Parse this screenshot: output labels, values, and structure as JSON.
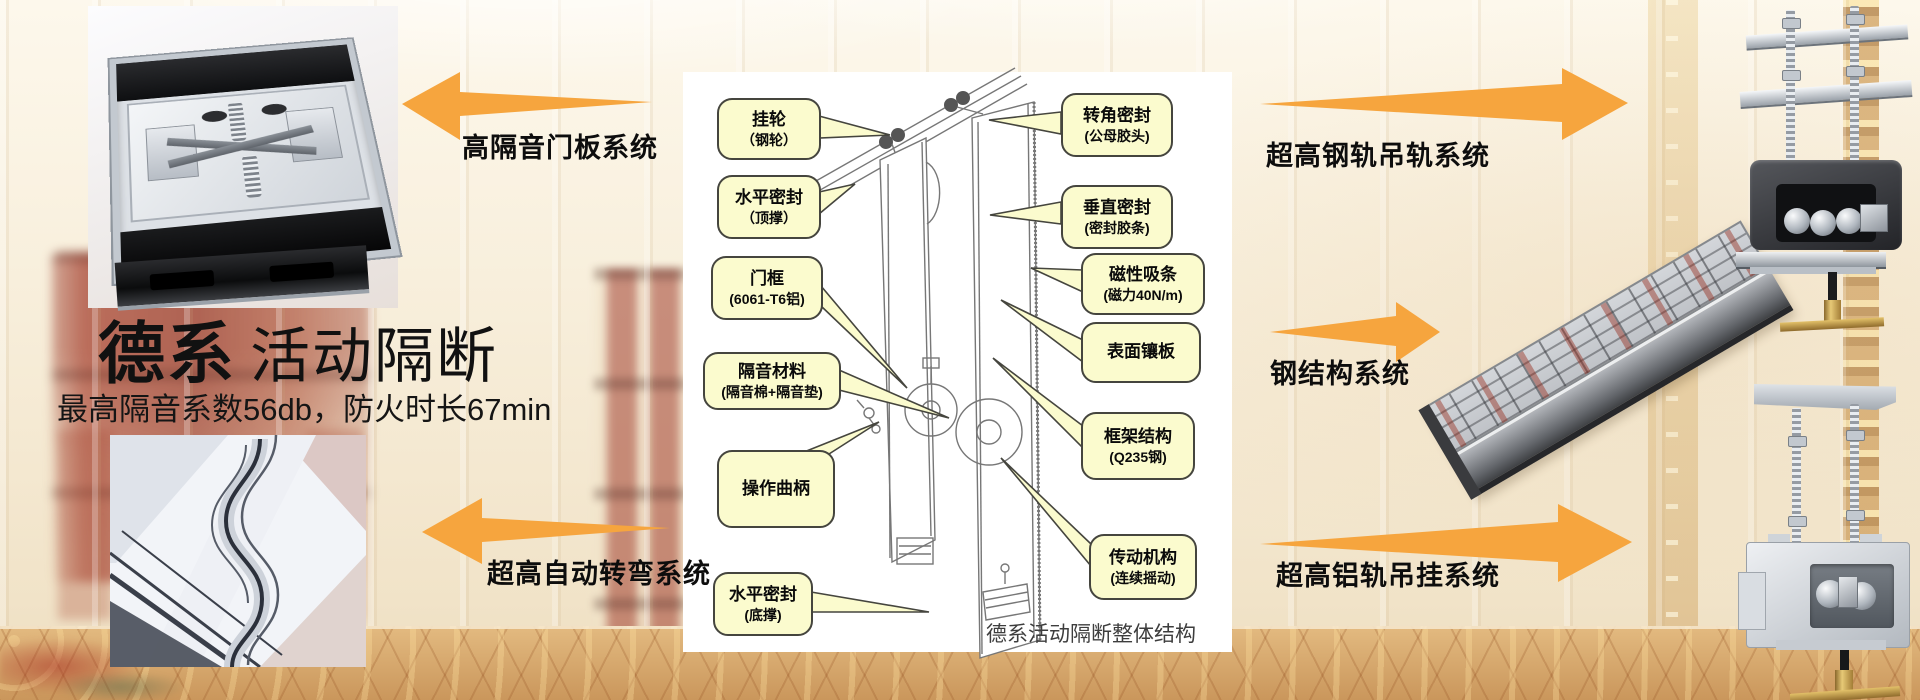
{
  "header": {
    "title_strong": "德系",
    "title_rest": "活动隔断",
    "subtitle": "最高隔音系数56db，防火时长67min"
  },
  "diagram": {
    "caption": "德系活动隔断整体结构",
    "labels_left": [
      {
        "line1": "挂轮",
        "line2": "（钢轮）"
      },
      {
        "line1": "水平密封",
        "line2": "（顶撑）"
      },
      {
        "line1": "门框",
        "line2": "(6061-T6铝)"
      },
      {
        "line1": "隔音材料",
        "line2": "(隔音棉+隔音垫)"
      },
      {
        "line1": "操作曲柄",
        "line2": ""
      },
      {
        "line1": "水平密封",
        "line2": "(底撑)"
      }
    ],
    "labels_right": [
      {
        "line1": "转角密封",
        "line2": "(公母胶头)"
      },
      {
        "line1": "垂直密封",
        "line2": "(密封胶条)"
      },
      {
        "line1": "磁性吸条",
        "line2": "(磁力40N/m)"
      },
      {
        "line1": "表面镶板",
        "line2": ""
      },
      {
        "line1": "框架结构",
        "line2": "(Q235钢)"
      },
      {
        "line1": "传动机构",
        "line2": "(连续摇动)"
      }
    ]
  },
  "systems": {
    "door_panel": "高隔音门板系统",
    "auto_turn": "超高自动转弯系统",
    "steel_rail": "超高钢轨吊轨系统",
    "steel_structure": "钢结构系统",
    "aluminum_rail": "超高铝轨吊挂系统"
  },
  "colors": {
    "arrow": "#F6A53E",
    "label-bg": "#FBFBCE",
    "label-border": "#45453E",
    "title-text": "#111111",
    "caption-text": "#3D3D3D"
  }
}
